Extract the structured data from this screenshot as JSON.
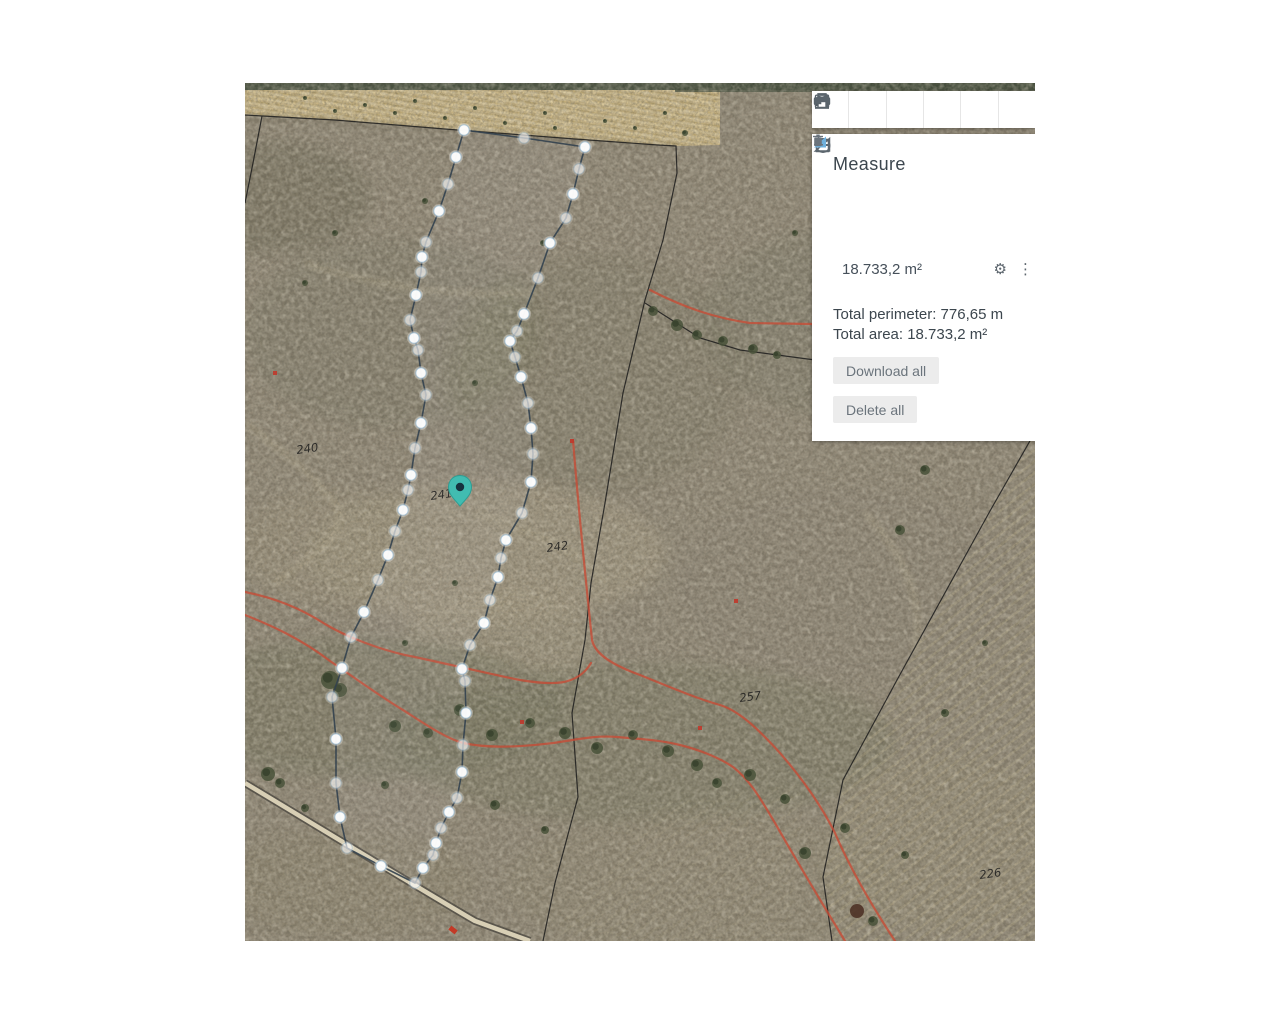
{
  "toolbar": {
    "items": [
      {
        "name": "ruler-icon",
        "title": "Measure distance"
      },
      {
        "name": "area-chart-icon",
        "title": "Terrain profile"
      },
      {
        "name": "heart-icon",
        "title": "Favourites"
      },
      {
        "name": "share-icon",
        "title": "Share"
      },
      {
        "name": "print-icon",
        "title": "Print"
      },
      {
        "name": "calendar-icon",
        "title": "Date"
      }
    ]
  },
  "measure_panel": {
    "title": "Measure",
    "tools": [
      {
        "name": "line-tool"
      },
      {
        "name": "angle-tool"
      },
      {
        "name": "rectangle-tool"
      },
      {
        "name": "circle-tool"
      }
    ],
    "result": {
      "value": "18.733,2 m²"
    },
    "totals": {
      "perimeter": "Total perimeter: 776,65 m",
      "area": "Total area: 18.733,2 m²"
    },
    "buttons": {
      "download": "Download all",
      "delete": "Delete all"
    }
  },
  "map": {
    "parcel_labels": [
      {
        "text": "240",
        "x": 52,
        "y": 371
      },
      {
        "text": "241",
        "x": 186,
        "y": 417
      },
      {
        "text": "242",
        "x": 302,
        "y": 469
      },
      {
        "text": "257",
        "x": 495,
        "y": 619
      },
      {
        "text": "226",
        "x": 735,
        "y": 796
      }
    ],
    "pin": {
      "x": 215,
      "y": 423,
      "color": "#41bcb1",
      "hole_color": "#16323e"
    },
    "measurement_polygon": {
      "stroke": "#33424f",
      "points": [
        [
          219,
          47
        ],
        [
          279,
          55
        ],
        [
          340,
          64
        ],
        [
          334,
          86
        ],
        [
          328,
          111
        ],
        [
          321,
          135
        ],
        [
          305,
          160
        ],
        [
          293,
          195
        ],
        [
          279,
          231
        ],
        [
          272,
          248
        ],
        [
          265,
          258
        ],
        [
          270,
          274
        ],
        [
          276,
          294
        ],
        [
          283,
          320
        ],
        [
          286,
          345
        ],
        [
          288,
          371
        ],
        [
          286,
          399
        ],
        [
          277,
          430
        ],
        [
          261,
          457
        ],
        [
          256,
          475
        ],
        [
          253,
          494
        ],
        [
          245,
          517
        ],
        [
          239,
          540
        ],
        [
          225,
          562
        ],
        [
          217,
          586
        ],
        [
          220,
          598
        ],
        [
          221,
          630
        ],
        [
          218,
          662
        ],
        [
          217,
          689
        ],
        [
          212,
          715
        ],
        [
          204,
          729
        ],
        [
          196,
          745
        ],
        [
          191,
          760
        ],
        [
          188,
          772
        ],
        [
          178,
          785
        ],
        [
          170,
          800
        ],
        [
          136,
          783
        ],
        [
          102,
          765
        ],
        [
          95,
          734
        ],
        [
          91,
          700
        ],
        [
          91,
          656
        ],
        [
          87,
          614
        ],
        [
          97,
          585
        ],
        [
          106,
          554
        ],
        [
          119,
          529
        ],
        [
          133,
          497
        ],
        [
          143,
          472
        ],
        [
          150,
          448
        ],
        [
          158,
          427
        ],
        [
          163,
          407
        ],
        [
          166,
          392
        ],
        [
          170,
          365
        ],
        [
          176,
          340
        ],
        [
          181,
          312
        ],
        [
          176,
          290
        ],
        [
          173,
          267
        ],
        [
          169,
          255
        ],
        [
          165,
          237
        ],
        [
          171,
          212
        ],
        [
          176,
          189
        ],
        [
          177,
          174
        ],
        [
          181,
          159
        ],
        [
          194,
          128
        ],
        [
          203,
          101
        ],
        [
          211,
          74
        ]
      ]
    },
    "red_markers": [
      [
        30,
        290
      ],
      [
        327,
        358
      ],
      [
        491,
        518
      ],
      [
        277,
        639
      ],
      [
        455,
        645
      ]
    ],
    "car": {
      "x": 208,
      "y": 847
    }
  }
}
